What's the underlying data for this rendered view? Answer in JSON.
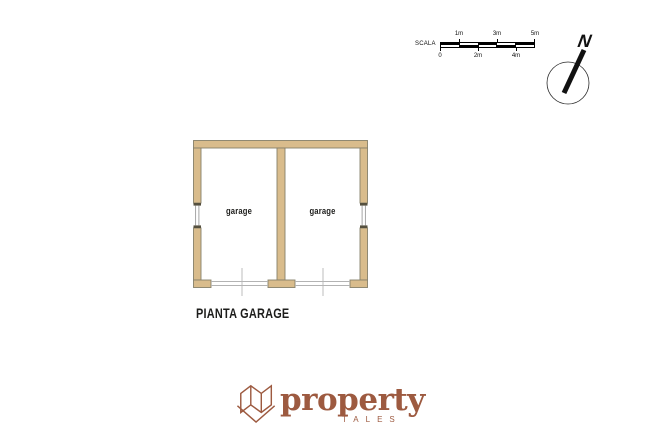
{
  "scale_bar": {
    "label": "SCALA",
    "top_ticks": [
      "1m",
      "3m",
      "5m"
    ],
    "bottom_ticks": [
      "0",
      "2m",
      "4m"
    ],
    "bar_color": "#000000"
  },
  "compass": {
    "north_label": "N"
  },
  "floor_plan": {
    "caption": "PIANTA GARAGE",
    "rooms": [
      {
        "label": "garage"
      },
      {
        "label": "garage"
      }
    ],
    "wall_fill": "#d9bc8c",
    "wall_outline": "#87806a",
    "opening_line_color": "#b3b3b3"
  },
  "logo": {
    "brand": "property",
    "subtitle": "TALES",
    "color": "#9d5a40",
    "icon": "folded-map-icon"
  }
}
